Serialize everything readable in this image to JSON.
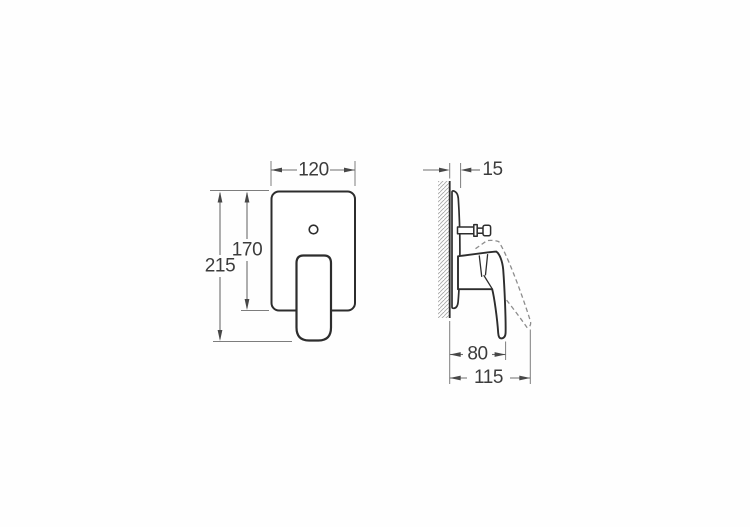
{
  "drawing": {
    "front_view": {
      "dim_width": "120",
      "dim_plate_height": "170",
      "dim_total_height": "215"
    },
    "side_view": {
      "dim_plate_depth": "15",
      "dim_handle_reach": "80",
      "dim_total_reach": "115"
    },
    "colors": {
      "background": "#fefefe",
      "outline": "#2d2d2d",
      "dimension_lines": "#6d6d6d",
      "dimension_text": "#3c3c3c",
      "hidden_position_dashed": "#8d8d8d",
      "wall_hatch": "#a8a8a8"
    }
  }
}
